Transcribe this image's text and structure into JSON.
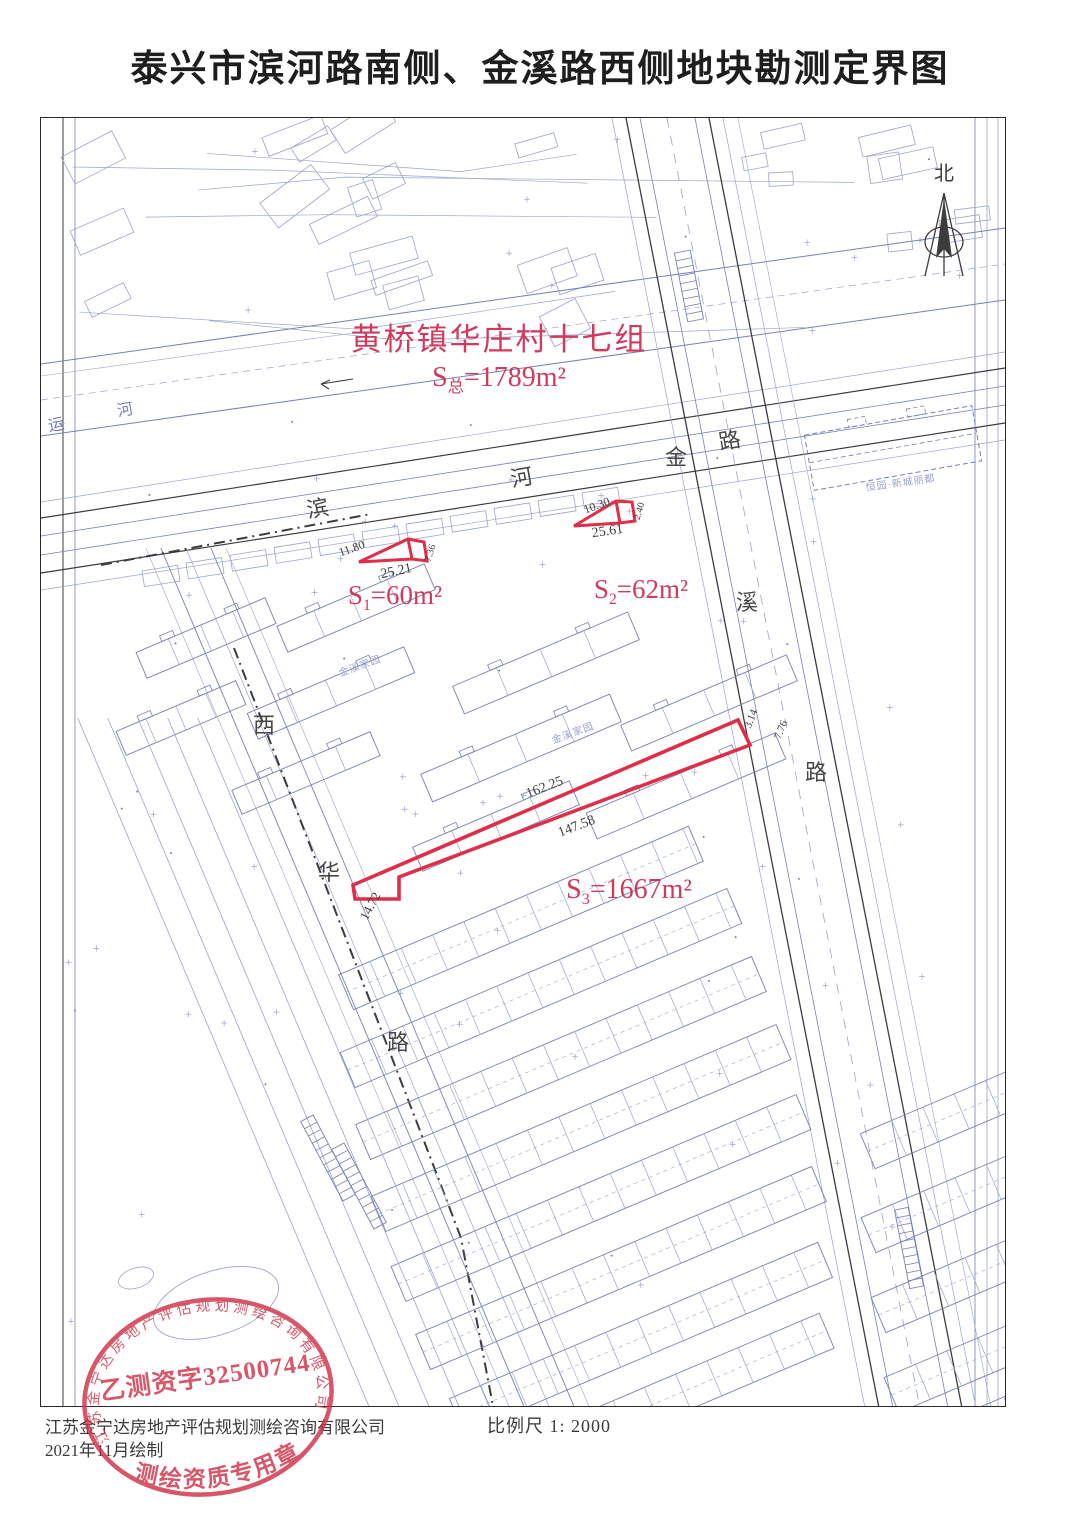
{
  "title": "泰兴市滨河路南侧、金溪路西侧地块勘测定界图",
  "north": {
    "label": "北"
  },
  "red_annotations": {
    "site": {
      "text": "黄桥镇华庄村十七组",
      "x": 458,
      "y": 232,
      "size": 31
    },
    "total": {
      "prefix": "S",
      "sub": "总",
      "rest": "=1789m²",
      "x": 458,
      "y": 268,
      "size": 28
    },
    "parcels": [
      {
        "prefix": "S",
        "sub": "1",
        "rest": "=60m²",
        "x": 354,
        "y": 486,
        "size": 27
      },
      {
        "prefix": "S",
        "sub": "2",
        "rest": "=62m²",
        "x": 600,
        "y": 480,
        "size": 27
      },
      {
        "prefix": "S",
        "sub": "3",
        "rest": "=1667m²",
        "x": 588,
        "y": 780,
        "size": 28
      }
    ]
  },
  "measurements": [
    {
      "text": "11.80",
      "x": 312,
      "y": 434,
      "rot": -20,
      "size": 12
    },
    {
      "text": "25.21",
      "x": 356,
      "y": 457,
      "rot": -12,
      "size": 14
    },
    {
      "text": "7.36",
      "x": 392,
      "y": 436,
      "rot": -72,
      "size": 10
    },
    {
      "text": "10.30",
      "x": 557,
      "y": 391,
      "rot": -20,
      "size": 12
    },
    {
      "text": "25.61",
      "x": 567,
      "y": 417,
      "rot": -8,
      "size": 14
    },
    {
      "text": "2.40",
      "x": 601,
      "y": 394,
      "rot": -72,
      "size": 10
    },
    {
      "text": "162.25",
      "x": 505,
      "y": 673,
      "rot": -21,
      "size": 14
    },
    {
      "text": "147.58",
      "x": 537,
      "y": 712,
      "rot": -21,
      "size": 14
    },
    {
      "text": "14.72",
      "x": 333,
      "y": 790,
      "rot": -62,
      "size": 13
    },
    {
      "text": "3.14",
      "x": 713,
      "y": 602,
      "rot": -68,
      "size": 11
    },
    {
      "text": "7.76",
      "x": 743,
      "y": 613,
      "rot": -68,
      "size": 11
    }
  ],
  "road_labels": [
    {
      "ch": "滨",
      "x": 278,
      "y": 398,
      "rot": -10,
      "size": 22
    },
    {
      "ch": "河",
      "x": 482,
      "y": 367,
      "rot": -10,
      "size": 22
    },
    {
      "ch": "路",
      "x": 690,
      "y": 330,
      "rot": -10,
      "size": 22
    },
    {
      "ch": "金",
      "x": 635,
      "y": 347,
      "rot": 0,
      "size": 22
    },
    {
      "ch": "溪",
      "x": 706,
      "y": 492,
      "rot": 0,
      "size": 22
    },
    {
      "ch": "路",
      "x": 775,
      "y": 662,
      "rot": 0,
      "size": 22
    },
    {
      "ch": "西",
      "x": 223,
      "y": 615,
      "rot": 0,
      "size": 22
    },
    {
      "ch": "华",
      "x": 288,
      "y": 762,
      "rot": 0,
      "size": 22
    },
    {
      "ch": "路",
      "x": 357,
      "y": 932,
      "rot": 0,
      "size": 22
    },
    {
      "ch": "运",
      "x": 16,
      "y": 312,
      "rot": -10,
      "size": 16,
      "light": true
    },
    {
      "ch": "河",
      "x": 85,
      "y": 297,
      "rot": -10,
      "size": 16,
      "light": true
    }
  ],
  "place_labels": [
    {
      "text": "金溪家园",
      "x": 320,
      "y": 551,
      "rot": -20
    },
    {
      "text": "金溪家园",
      "x": 533,
      "y": 618,
      "rot": -20
    },
    {
      "text": "恒园·新城丽都",
      "x": 860,
      "y": 368,
      "rot": -8
    }
  ],
  "footer": {
    "company_line": "江苏金宁达房地产评估规划测绘咨询有限公司",
    "date_line": "2021年11月绘制",
    "scale_label": "比例尺 1: 2000"
  },
  "stamp": {
    "ring_text": "江苏金宁达房地产评估规划测绘咨询有限公司",
    "center_text": "乙测资字32500744",
    "bottom_text": "测绘资质专用章"
  },
  "colors": {
    "red_text": "#d23a5c",
    "red_parcel": "#e02e48",
    "stamp_red": "#cf3349",
    "line_light": "#9aa4ce",
    "line_mid": "#7681b4",
    "ink": "#3c3c3c"
  }
}
